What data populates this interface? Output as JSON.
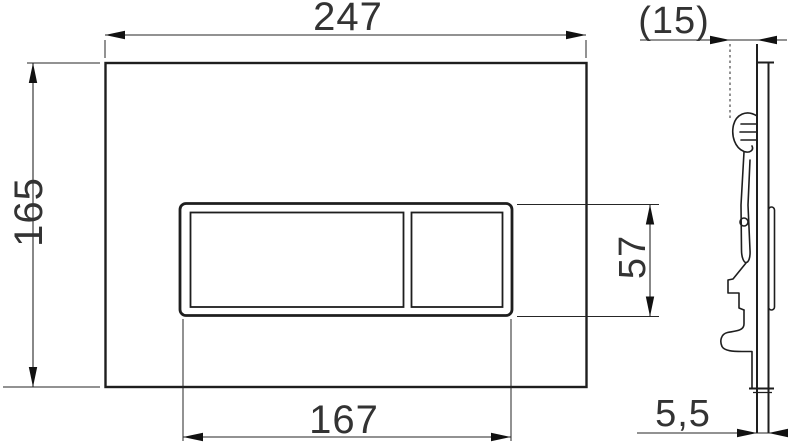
{
  "meta": {
    "drawing_type": "technical dimension drawing",
    "subject": "flush plate - front view and side profile view",
    "background_color": "#ffffff",
    "line_color": "#1e1e1e",
    "text_color": "#333333"
  },
  "front_view": {
    "dimensions": {
      "overall_width": {
        "label": "247"
      },
      "overall_height": {
        "label": "165"
      },
      "button_panel_width": {
        "label": "167"
      },
      "button_panel_height": {
        "label": "57"
      }
    }
  },
  "side_view": {
    "dimensions": {
      "overall_depth": {
        "label": "(15)"
      },
      "plate_thickness": {
        "label": "5,5"
      }
    }
  }
}
